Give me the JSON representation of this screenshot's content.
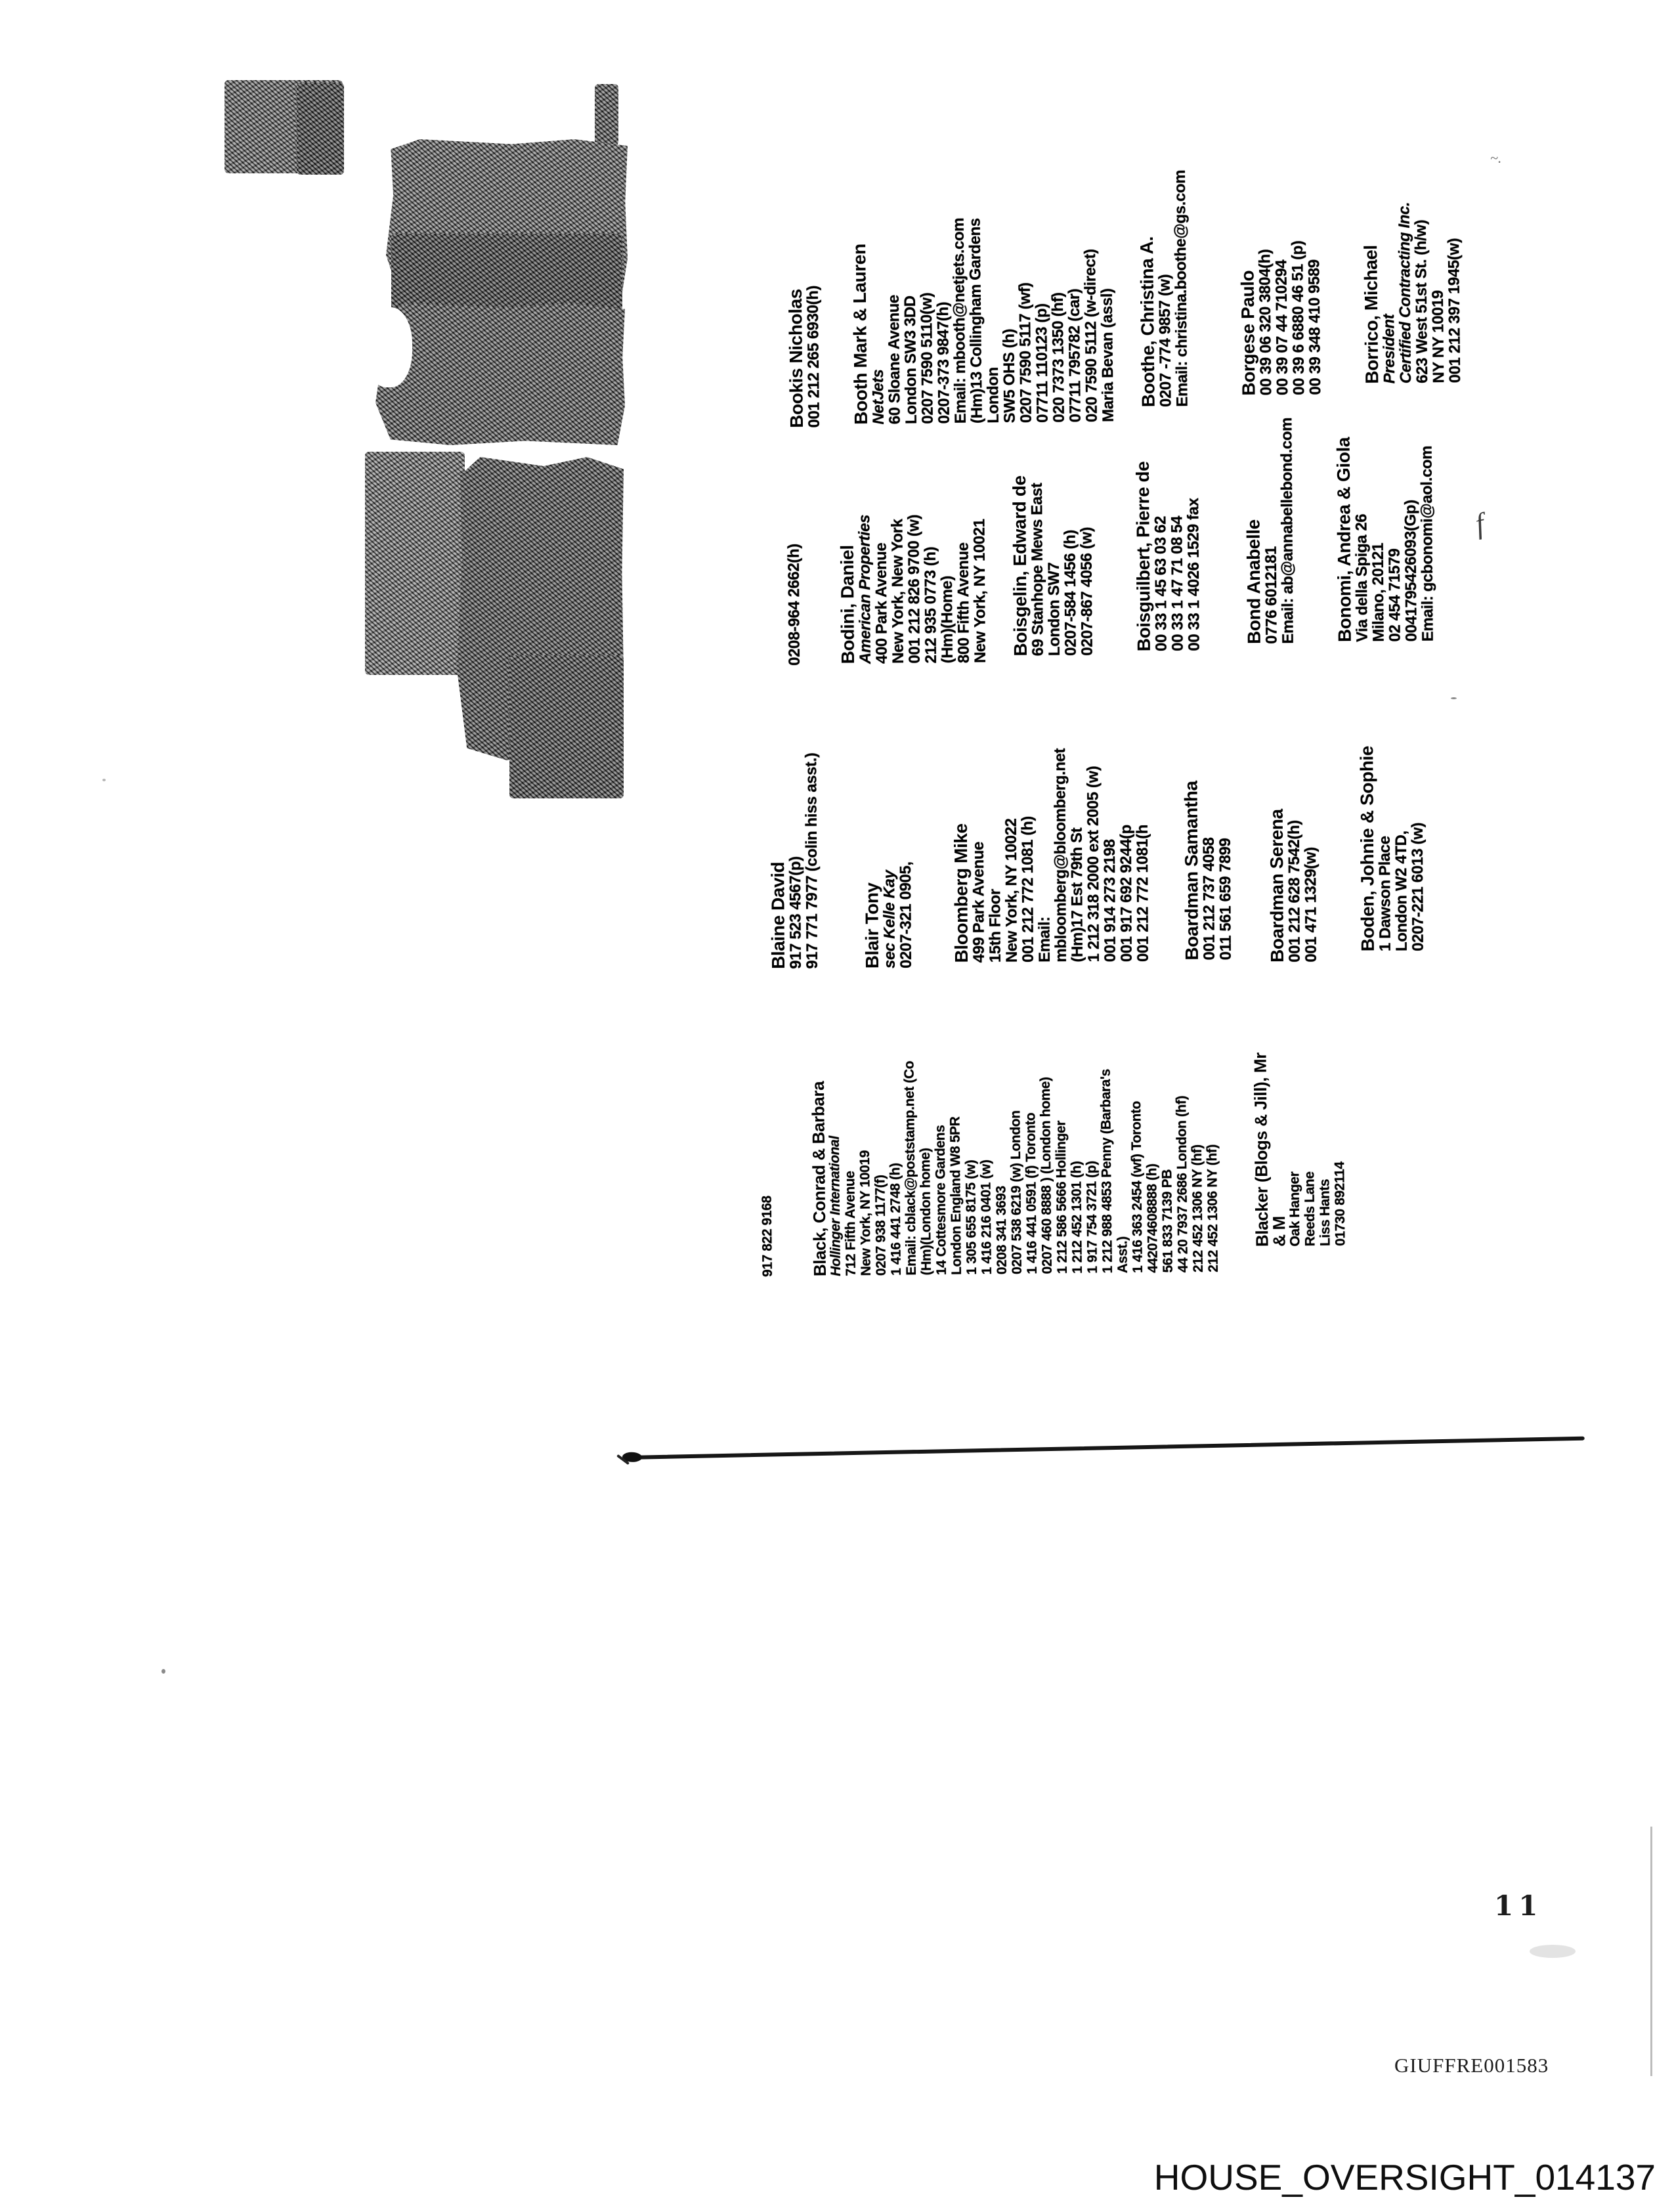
{
  "page": {
    "number": "11",
    "bates_stamp": "GIUFFRE001583",
    "footer_stamp": "HOUSE_OVERSIGHT_014137"
  },
  "columns": [
    {
      "entries": [
        {
          "name": "Bookis Nicholas",
          "lines": [
            {
              "t": "001 212 265 6930(h)"
            }
          ]
        },
        {
          "name": "Booth Mark & Lauren",
          "lines": [
            {
              "t": "NetJets",
              "i": true
            },
            {
              "t": "60 Sloane Avenue"
            },
            {
              "t": "London SW3 3DD"
            },
            {
              "t": "0207 7590 5110(w)"
            },
            {
              "t": "0207-373 9847(h)"
            },
            {
              "t": "Email: mbooth@netjets.com"
            },
            {
              "t": "(Hm)13 Collingham Gardens"
            },
            {
              "t": "London"
            },
            {
              "t": "SW5 OHS (h)"
            },
            {
              "t": "0207 7590 5117 (wf)"
            },
            {
              "t": "07711 110123 (p)"
            },
            {
              "t": "020 7373 1350 (hf)"
            },
            {
              "t": "07711 795782 (car)"
            },
            {
              "t": "020 7590 5112 (w-direct)"
            },
            {
              "t": "Maria Bevan (assl)"
            }
          ]
        },
        {
          "name": "Boothe, Christina A.",
          "lines": [
            {
              "t": "0207 -774 9857 (w)"
            },
            {
              "t": "Email: christina.boothe@gs.com"
            }
          ]
        },
        {
          "name": "Borgese Paulo",
          "lines": [
            {
              "t": "00 39 06 320 3804(h)"
            },
            {
              "t": "00 39 07 44 710294"
            },
            {
              "t": "00 39 6 6880 46 51 (p)"
            },
            {
              "t": "00 39 348 410 9589"
            }
          ]
        },
        {
          "name": "Borrico, Michael",
          "lines": [
            {
              "t": "President",
              "i": true
            },
            {
              "t": "Certified Contracting Inc.",
              "i": true
            },
            {
              "t": "623 West 51st St. (h/w)"
            },
            {
              "t": "NY NY 10019"
            },
            {
              "t": "001 212 397 1945(w)"
            }
          ]
        }
      ]
    },
    {
      "entries": [
        {
          "name": "",
          "lines": [
            {
              "t": "0208-964 2662(h)"
            }
          ]
        },
        {
          "name": "Bodini, Daniel",
          "lines": [
            {
              "t": "American Properties",
              "i": true
            },
            {
              "t": "400 Park Avenue"
            },
            {
              "t": "New York, New York"
            },
            {
              "t": "001 212 826 9700 (w)"
            },
            {
              "t": "212 935 0773 (h)"
            },
            {
              "t": "(Hm)(Home)"
            },
            {
              "t": "800 Fifth Avenue"
            },
            {
              "t": "New York, NY 10021"
            }
          ]
        },
        {
          "name": "Boisgelin, Edward de",
          "lines": [
            {
              "t": "69 Stanhope Mews East"
            },
            {
              "t": "London SW7"
            },
            {
              "t": "0207-584 1456 (h)"
            },
            {
              "t": "0207-867 4056 (w)"
            }
          ]
        },
        {
          "name": "Boisguilbert, Pierre de",
          "lines": [
            {
              "t": "00 33 1 45 63 03 62"
            },
            {
              "t": "00 33 1 47 71 08 54"
            },
            {
              "t": "00 33 1 4026 1529 fax"
            }
          ]
        },
        {
          "name": "Bond Anabelle",
          "lines": [
            {
              "t": "0776 6012181"
            },
            {
              "t": "Email: ab@annabellebond.com"
            }
          ]
        },
        {
          "name": "Bonomi, Andrea & Giola",
          "lines": [
            {
              "t": "Via della Spiga 26"
            },
            {
              "t": "Milano, 20121"
            },
            {
              "t": "02 454 71579"
            },
            {
              "t": "0041795426093(Gp)"
            },
            {
              "t": "Email: gcbonomi@aol.com"
            }
          ]
        }
      ]
    },
    {
      "entries": [
        {
          "name": "Blaine David",
          "lines": [
            {
              "t": "917 523 4567(p)"
            },
            {
              "t": "917 771 7977 (colin hiss asst.)"
            }
          ]
        },
        {
          "name": "Blair Tony",
          "lines": [
            {
              "t": "sec Kelle Kay",
              "i": true
            },
            {
              "t": "0207-321 0905,"
            }
          ]
        },
        {
          "name": "Bloomberg Mike",
          "lines": [
            {
              "t": "499 Park Avenue"
            },
            {
              "t": "15th Floor"
            },
            {
              "t": "New York, NY 10022"
            },
            {
              "t": "001 212 772 1081 (h)"
            },
            {
              "t": "Email:"
            },
            {
              "t": "mbloomberg@bloomberg.net"
            },
            {
              "t": "(Hm)17 Est 79th St"
            },
            {
              "t": "1 212 318 2000 ext 2005 (w)"
            },
            {
              "t": "001 914 273 2198"
            },
            {
              "t": "001 917 692 9244(p"
            },
            {
              "t": "001 212 772 1081(h"
            }
          ]
        },
        {
          "name": "Boardman Samantha",
          "lines": [
            {
              "t": "001 212 737 4058"
            },
            {
              "t": "011 561 659 7899"
            }
          ]
        },
        {
          "name": "Boardman Serena",
          "lines": [
            {
              "t": "001 212 628 7542(h)"
            },
            {
              "t": "001 471 1329(w)"
            }
          ]
        },
        {
          "name": "Boden, Johnie & Sophie",
          "lines": [
            {
              "t": "1 Dawson Place"
            },
            {
              "t": "London W2 4TD,"
            },
            {
              "t": "0207-221 6013 (w)"
            }
          ]
        }
      ]
    },
    {
      "entries": [
        {
          "name": "",
          "lines": [
            {
              "t": "917 822 9168"
            }
          ]
        },
        {
          "name": "Black, Conrad & Barbara",
          "lines": [
            {
              "t": "Hollinger International",
              "i": true
            },
            {
              "t": "712 Fifth Avenue"
            },
            {
              "t": "New York, NY 10019"
            },
            {
              "t": "0207 938 1177(f)"
            },
            {
              "t": "1 416 441 2748 (h)"
            },
            {
              "t": "Email: cblack@poststamp.net (Co"
            },
            {
              "t": "(Hm)(London home)"
            },
            {
              "t": "14 Cottesmore Gardens"
            },
            {
              "t": "London England W8 5PR"
            },
            {
              "t": "1 305 655 8175 (w)"
            },
            {
              "t": "1 416 216 0401 (w)"
            },
            {
              "t": "0208 341 3693"
            },
            {
              "t": "0207 538 6219 (w) London"
            },
            {
              "t": "1 416 441 0591 (f) Toronto"
            },
            {
              "t": "0207 460 8888 ) (London home)"
            },
            {
              "t": "1 212 586 5666 Hollinger"
            },
            {
              "t": "1 212 452 1301 (h)"
            },
            {
              "t": "1 917 754 3721 (p)"
            },
            {
              "t": "1 212 988 4853 Penny (Barbara's"
            },
            {
              "t": "Asst.)"
            },
            {
              "t": "1 416 363 2454 (wf) Toronto"
            },
            {
              "t": "442074608888 (h)"
            },
            {
              "t": "561 833 7139 PB"
            },
            {
              "t": "44 20 7937 2686 London (hf)"
            },
            {
              "t": "212 452 1306 NY (hf)"
            },
            {
              "t": "212 452 1306 NY (hf)"
            }
          ]
        },
        {
          "name": "Blacker (Blogs & Jill), Mr",
          "name2": "& M",
          "lines": [
            {
              "t": "Oak Hanger"
            },
            {
              "t": "Reeds Lane"
            },
            {
              "t": "Liss Hants"
            },
            {
              "t": "01730 892114"
            }
          ]
        }
      ]
    }
  ]
}
